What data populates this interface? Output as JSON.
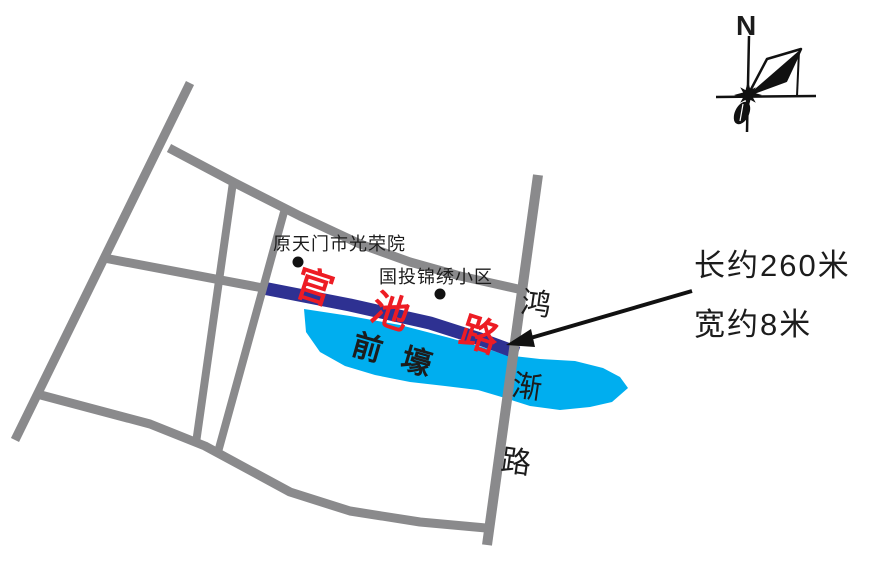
{
  "colors": {
    "road_gray": "#8a8a8c",
    "project_road_blue": "#2e3192",
    "water_blue": "#00aeef",
    "label_red": "#ed1c24",
    "ink": "#1c1c1c"
  },
  "compass": {
    "north_label": "N"
  },
  "pois": [
    {
      "label": "原天门市光荣院"
    },
    {
      "label": "国投锦绣小区"
    }
  ],
  "project_road": {
    "name": "官池路",
    "chars": [
      "官",
      "池",
      "路"
    ]
  },
  "cross_road": {
    "name": "鸿渐路",
    "chars": [
      "鸿",
      "渐",
      "路"
    ]
  },
  "water": {
    "name": "前壕",
    "chars": [
      "前",
      "壕"
    ]
  },
  "annotation": {
    "length": "长约260米",
    "width": "宽约8米"
  }
}
